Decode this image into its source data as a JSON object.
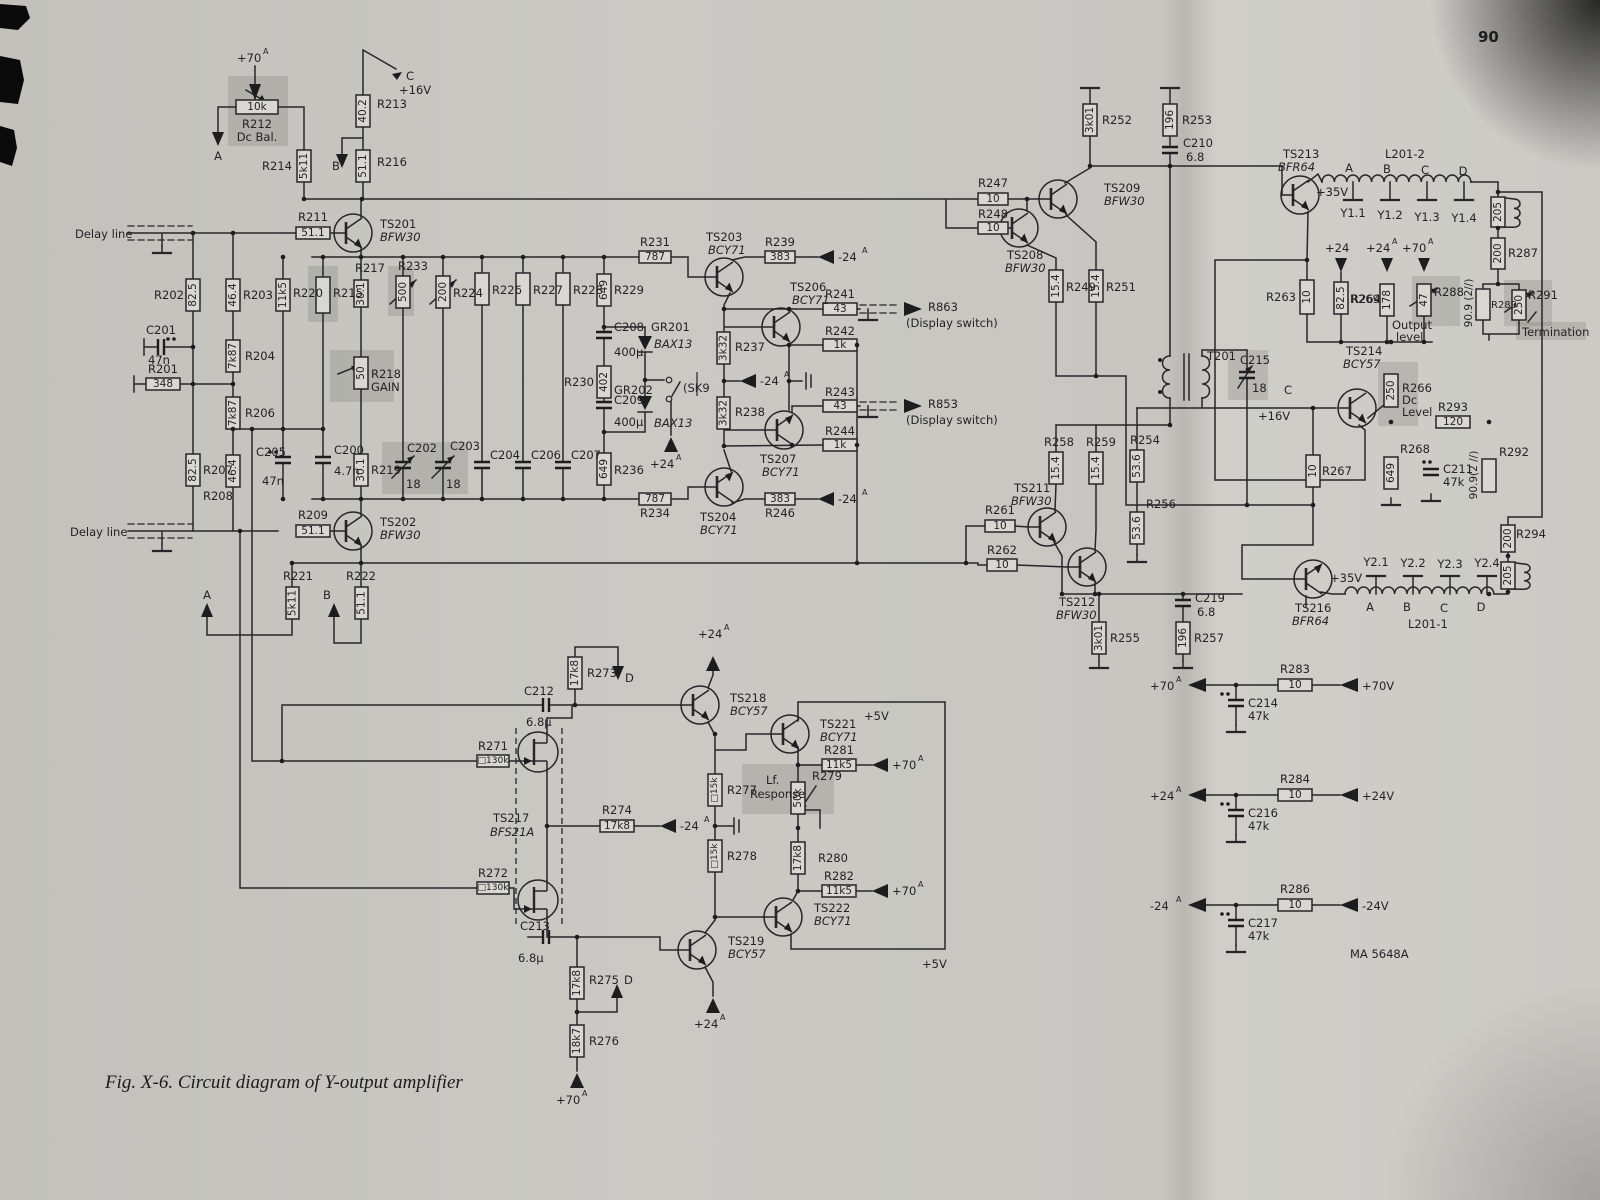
{
  "page": {
    "number": "90",
    "caption": "Fig. X-6. Circuit diagram of Y-output amplifier",
    "part_code": "MA 5648A"
  },
  "labels": {
    "delay": "Delay line",
    "mkA": "A",
    "mkB": "B",
    "mkC": "C",
    "mkD": "D",
    "p70": "+70",
    "p24": "+24",
    "m24": "-24",
    "p16": "+16V",
    "p35": "+35V",
    "p5": "+5V",
    "p70v": "+70V",
    "p24v": "+24V",
    "m24v": "-24V",
    "r201": "R201",
    "r201v": "348",
    "r202": "R202",
    "r202v": "82.5",
    "r203": "R203",
    "r203v": "46.4",
    "r204": "R204",
    "r204v": "7k87",
    "r206": "R206",
    "r206v": "7k87",
    "r207": "R207",
    "r207v": "82.5",
    "r208": "R208",
    "r208v": "46.4",
    "r209": "R209",
    "r209v": "51.1",
    "r211": "R211",
    "r211v": "51.1",
    "r212": "R212",
    "r212v": "10k",
    "r212n": "Dc Bal.",
    "r213": "R213",
    "r213v": "40.2",
    "r214": "R214",
    "r214v": "5k11",
    "r215": "R215",
    "r216": "R216",
    "r216v": "51.1",
    "r217": "R217",
    "r217v": "30.1",
    "r218": "R218",
    "r218v": "50",
    "r218n": "GAIN",
    "r219": "R219",
    "r219v": "30.1",
    "r220": "R220",
    "r220v": "11k5",
    "r221": "R221",
    "r221v": "5k11",
    "r222": "R222",
    "r222v": "51.1",
    "r224": "R224",
    "r224v": "200",
    "r226": "R226",
    "r227": "R227",
    "r228": "R228",
    "r229": "R229",
    "r229v": "649",
    "r230": "R230",
    "r230v": "402",
    "r231": "R231",
    "r231v": "787",
    "r233": "R233",
    "r233v": "500",
    "r234": "R234",
    "r234v": "787",
    "r236": "R236",
    "r236v": "649",
    "r237": "R237",
    "r237v": "3k32",
    "r238": "R238",
    "r238v": "3k32",
    "r239": "R239",
    "r239v": "383",
    "r241": "R241",
    "r241v": "43",
    "r242": "R242",
    "r242v": "1k",
    "r243": "R243",
    "r243v": "43",
    "r244": "R244",
    "r244v": "1k",
    "r246": "R246",
    "r246v": "383",
    "r247": "R247",
    "r247v": "10",
    "r248": "R248",
    "r248v": "10",
    "r249": "R249",
    "r249v": "15.4",
    "r251": "R251",
    "r251v": "15.4",
    "r252": "R252",
    "r252v": "3k01",
    "r253": "R253",
    "r253v": "196",
    "r254": "R254",
    "r254v": "53.6",
    "r255": "R255",
    "r255v": "3k01",
    "r256": "R256",
    "r256v": "53.6",
    "r257": "R257",
    "r257v": "196",
    "r258": "R258",
    "r258v": "15.4",
    "r259": "R259",
    "r259v": "15.4",
    "r261": "R261",
    "r261v": "10",
    "r262": "R262",
    "r262v": "10",
    "r263": "R263",
    "r263v": "10",
    "r264": "R264",
    "r264v": "82.5",
    "r266": "R266",
    "r266v": "250",
    "r266n1": "Dc",
    "r266n2": "Level",
    "r267": "R267",
    "r267v": "10",
    "r268": "R268",
    "r268v": "649",
    "r269": "R269",
    "r269v": "178",
    "r271": "R271",
    "r271v": "□130k",
    "r272": "R272",
    "r272v": "□130k",
    "r273": "R273",
    "r273v": "17k8",
    "r274": "R274",
    "r274v": "17k8",
    "r275": "R275",
    "r275v": "17k8",
    "r276": "R276",
    "r276v": "18k7",
    "r277": "R277",
    "r277v": "□15k",
    "r278": "R278",
    "r278v": "□15k",
    "r279": "R279",
    "r279v": "50k",
    "lf1": "Lf.",
    "lf2": "Response",
    "r280": "R280",
    "r280v": "17k8",
    "r281": "R281",
    "r281v": "11k5",
    "r282": "R282",
    "r282v": "11k5",
    "r283": "R283",
    "r283v": "10",
    "r284": "R284",
    "r284v": "10",
    "r286": "R286",
    "r286v": "10",
    "r287": "R287",
    "r287v": "200",
    "r288": "R288",
    "r288v": "47",
    "outn1": "Output",
    "outn2": "level",
    "r289": "R289",
    "r289v": "90.9 (2//)",
    "r291": "R291",
    "r291v": "250",
    "termn": "Termination",
    "r292": "R292",
    "r292v": "90.9(2 //)",
    "r293": "R293",
    "r293v": "120",
    "r294": "R294",
    "r294v": "200",
    "r205v": "205",
    "r863": "R863",
    "r853": "R853",
    "disp": "(Display switch)",
    "sk9": "(SK9",
    "c200": "C200",
    "c200v": "4.7n",
    "c201": "C201",
    "c201v": "47n",
    "c202": "C202",
    "c202v": "18",
    "c203": "C203",
    "c203v": "18",
    "c204": "C204",
    "c205": "C205",
    "c205v": "47n",
    "c206": "C206",
    "c207": "C207",
    "c208": "C208",
    "c208v": "400µ",
    "c209": "C209",
    "c209v": "400µ",
    "c210": "C210",
    "c210v": "6.8",
    "c211": "C211",
    "c211v": "47k",
    "c212": "C212",
    "c212v": "6.8µ",
    "c213": "C213",
    "c213v": "6.8µ",
    "c214": "C214",
    "c214v": "47k",
    "c215": "C215",
    "c215v": "18",
    "c216": "C216",
    "c216v": "47k",
    "c217": "C217",
    "c217v": "47k",
    "c219": "C219",
    "c219v": "6.8",
    "gr201": "GR201",
    "gr202": "GR202",
    "bax": "BAX13",
    "t201": "T201",
    "l2012": "L201-2",
    "l2011": "L201-1",
    "y11": "Y1.1",
    "y12": "Y1.2",
    "y13": "Y1.3",
    "y14": "Y1.4",
    "y21": "Y2.1",
    "y22": "Y2.2",
    "y23": "Y2.3",
    "y24": "Y2.4",
    "ts201": "TS201",
    "ts202": "TS202",
    "ts203": "TS203",
    "ts204": "TS204",
    "ts206": "TS206",
    "ts207": "TS207",
    "ts208": "TS208",
    "ts209": "TS209",
    "ts211": "TS211",
    "ts212": "TS212",
    "ts213": "TS213",
    "ts214": "TS214",
    "ts216": "TS216",
    "ts217": "TS217",
    "ts218": "TS218",
    "ts219": "TS219",
    "ts221": "TS221",
    "ts222": "TS222",
    "bfw30": "BFW30",
    "bcy71": "BCY71",
    "bcy57": "BCY57",
    "bfr64": "BFR64",
    "bfs21a": "BFS21A"
  }
}
